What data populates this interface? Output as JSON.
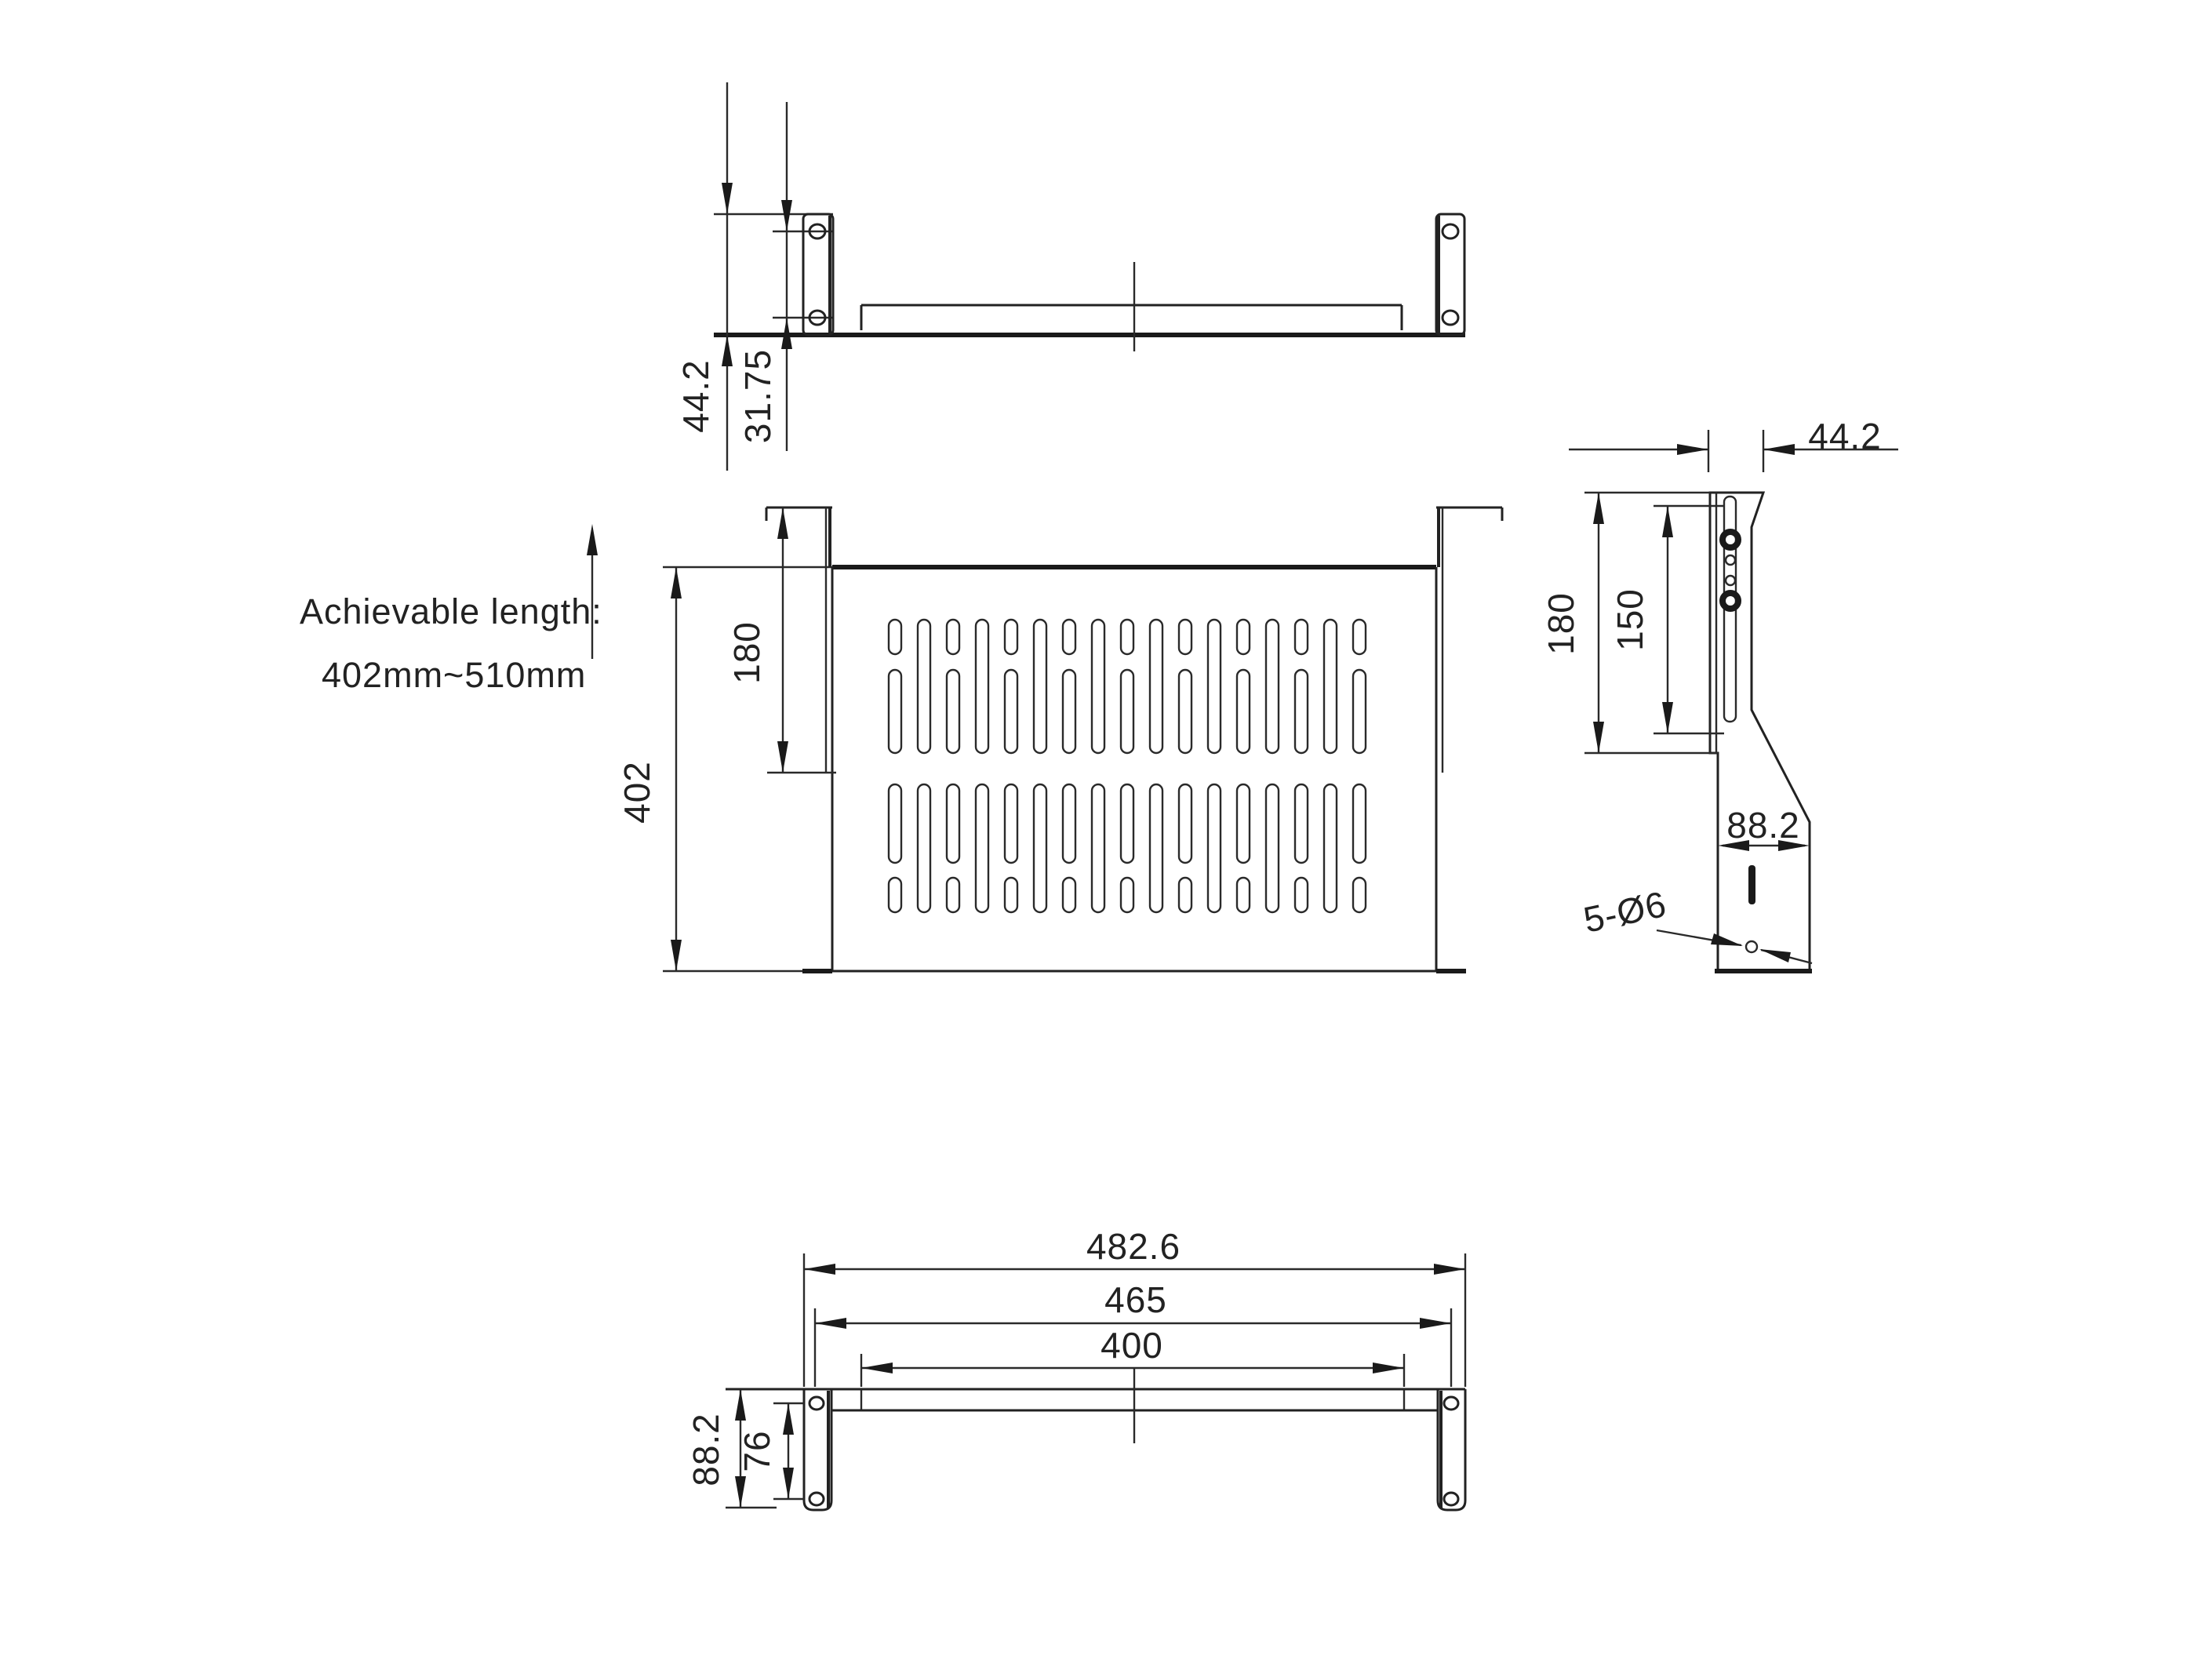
{
  "drawing": {
    "title": "rack-shelf-technical-drawing",
    "background": "#ffffff",
    "line_color": "#1a1a1a"
  },
  "note": {
    "line1": "Achievable length:",
    "line2": "402mm~510mm"
  },
  "views": {
    "front": {
      "dims": {
        "overall_height": "44.2",
        "hole_spacing": "31.75"
      }
    },
    "plan": {
      "dims": {
        "overall_depth": "402",
        "bracket_depth": "180"
      }
    },
    "side": {
      "dims": {
        "top_width": "44.2",
        "bracket_depth": "180",
        "slot_length": "150",
        "bottom_width": "88.2",
        "hole_note": "5-Ø6"
      }
    },
    "bottom": {
      "dims": {
        "overall_width": "482.6",
        "mounting_width": "465",
        "inner_width": "400",
        "ear_height": "88.2",
        "ear_hole_spacing": "76"
      }
    }
  }
}
